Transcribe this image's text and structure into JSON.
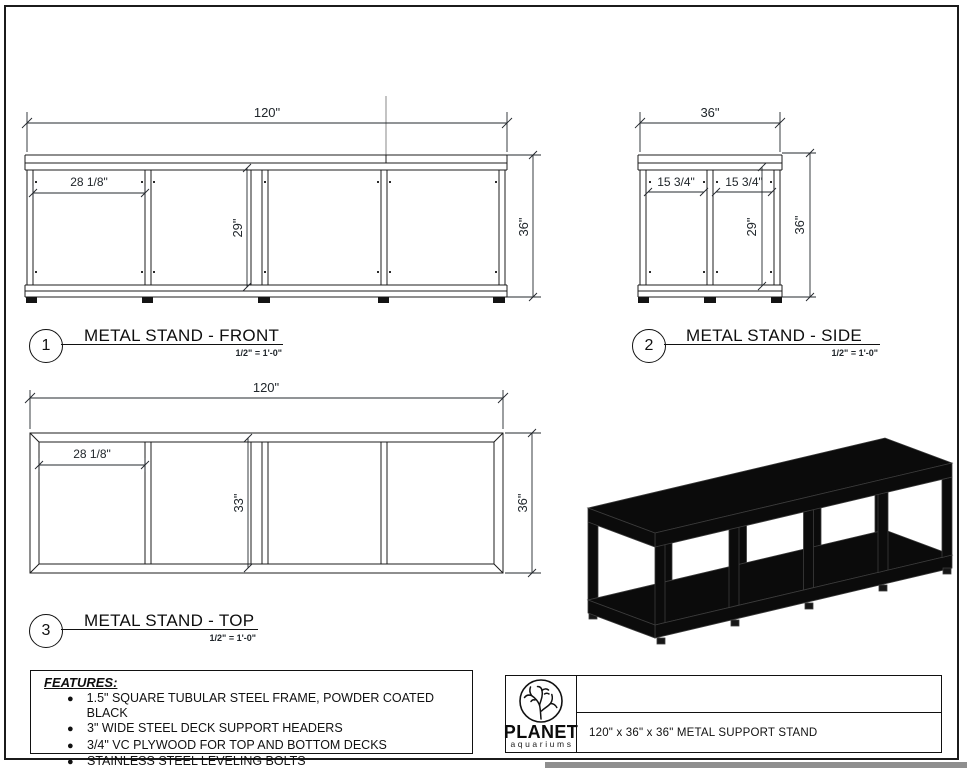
{
  "sheet": {
    "front_view": {
      "number": "1",
      "title": "METAL STAND - FRONT",
      "scale": "1/2\" = 1'-0\"",
      "dim_width": "120\"",
      "dim_bay": "28 1/8\"",
      "dim_clear_height": "29\"",
      "dim_height": "36\""
    },
    "side_view": {
      "number": "2",
      "title": "METAL STAND - SIDE",
      "scale": "1/2\" = 1'-0\"",
      "dim_width": "36\"",
      "dim_bay_left": "15 3/4\"",
      "dim_bay_right": "15 3/4\"",
      "dim_clear_height": "29\"",
      "dim_height": "36\""
    },
    "top_view": {
      "number": "3",
      "title": "METAL STAND - TOP",
      "scale": "1/2\" = 1'-0\"",
      "dim_width": "120\"",
      "dim_bay": "28 1/8\"",
      "dim_clear_depth": "33\"",
      "dim_depth": "36\""
    },
    "features": {
      "heading": "FEATURES:",
      "items": [
        "1.5\" SQUARE TUBULAR STEEL FRAME, POWDER COATED BLACK",
        "3\" WIDE STEEL DECK SUPPORT HEADERS",
        "3/4\" VC PLYWOOD FOR TOP AND BOTTOM DECKS",
        "STAINLESS STEEL LEVELING BOLTS"
      ]
    },
    "title_block": {
      "brand_name": "PLANET",
      "brand_sub": "aquariums",
      "drawing_title": "120\" x 36\" x 36\" METAL SUPPORT STAND"
    }
  }
}
